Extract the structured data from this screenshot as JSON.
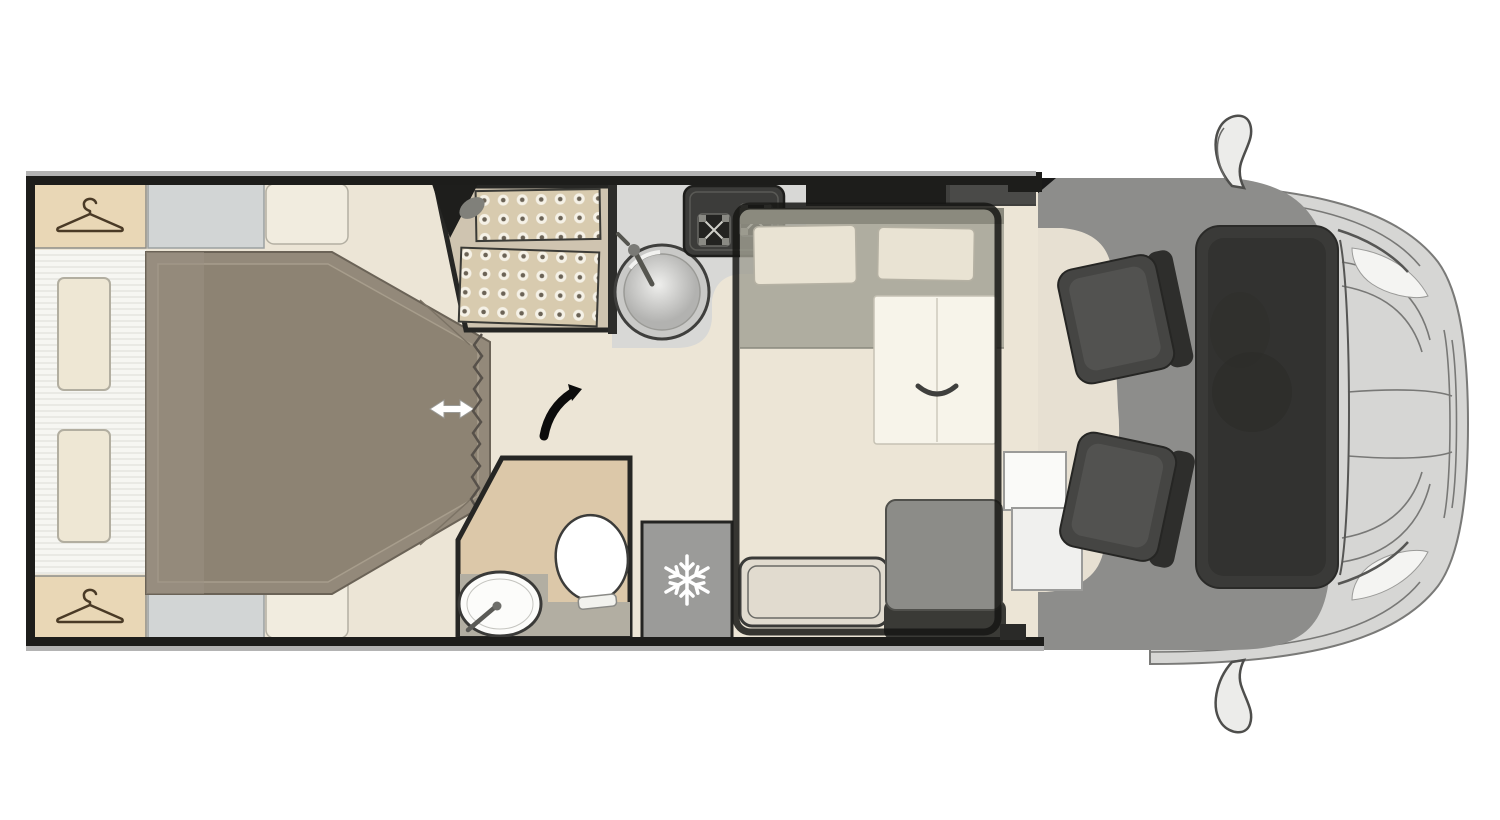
{
  "palette": {
    "wall": "#1d1d1b",
    "floor": "#ece5d6",
    "wardrobe": "#e9d7b6",
    "cabinet_gray": "#d2d5d5",
    "cabinet_cream": "#f1ecdf",
    "bed": "#93897a",
    "bed_inner": "#8d8373",
    "tile_base": "#d8cbaf",
    "counter": "#d8d8d6",
    "stove": "#3c3c3a",
    "bench": "#a09f92",
    "headrest": "#e9e3d3",
    "table": "#f7f4ea",
    "fridge": "#9b9b99",
    "bathroom_floor": "#dcc8a9",
    "seat_cushion": "#8c8c88",
    "seat_back": "#3a3a36",
    "swivel_seat": "#454543",
    "cab_body": "#d6d6d4",
    "cab_floor": "#8d8d8b",
    "windshield": "#3a3a38",
    "drop_bed_outline": "#161614",
    "arrow_white": "#ffffff",
    "arrow_black": "#0c0c0c",
    "hanger_brown": "#4a3a26",
    "snowflake_white": "#ffffff"
  },
  "icons": {
    "hanger": "coat-hanger",
    "snowflake": "snowflake",
    "slide_arrow": "horizontal-double-arrow",
    "door_swing": "curved-swing-arrow"
  },
  "features": [
    "rear-wardrobe-top",
    "rear-wardrobe-bottom",
    "headboard-shelf",
    "island-bed",
    "shower-cabin",
    "shower-curtain",
    "washroom",
    "toilet",
    "washroom-sink",
    "kitchen-counter",
    "kitchen-sink",
    "two-burner-hob",
    "overhead-lockers",
    "fridge-freezer",
    "dinette-bench",
    "headrests",
    "folding-table",
    "drop-down-bed-outline",
    "travel-seat",
    "bench-frame",
    "entry-steps",
    "driver-swivel-seat",
    "passenger-swivel-seat",
    "cab-front",
    "wing-mirrors"
  ]
}
